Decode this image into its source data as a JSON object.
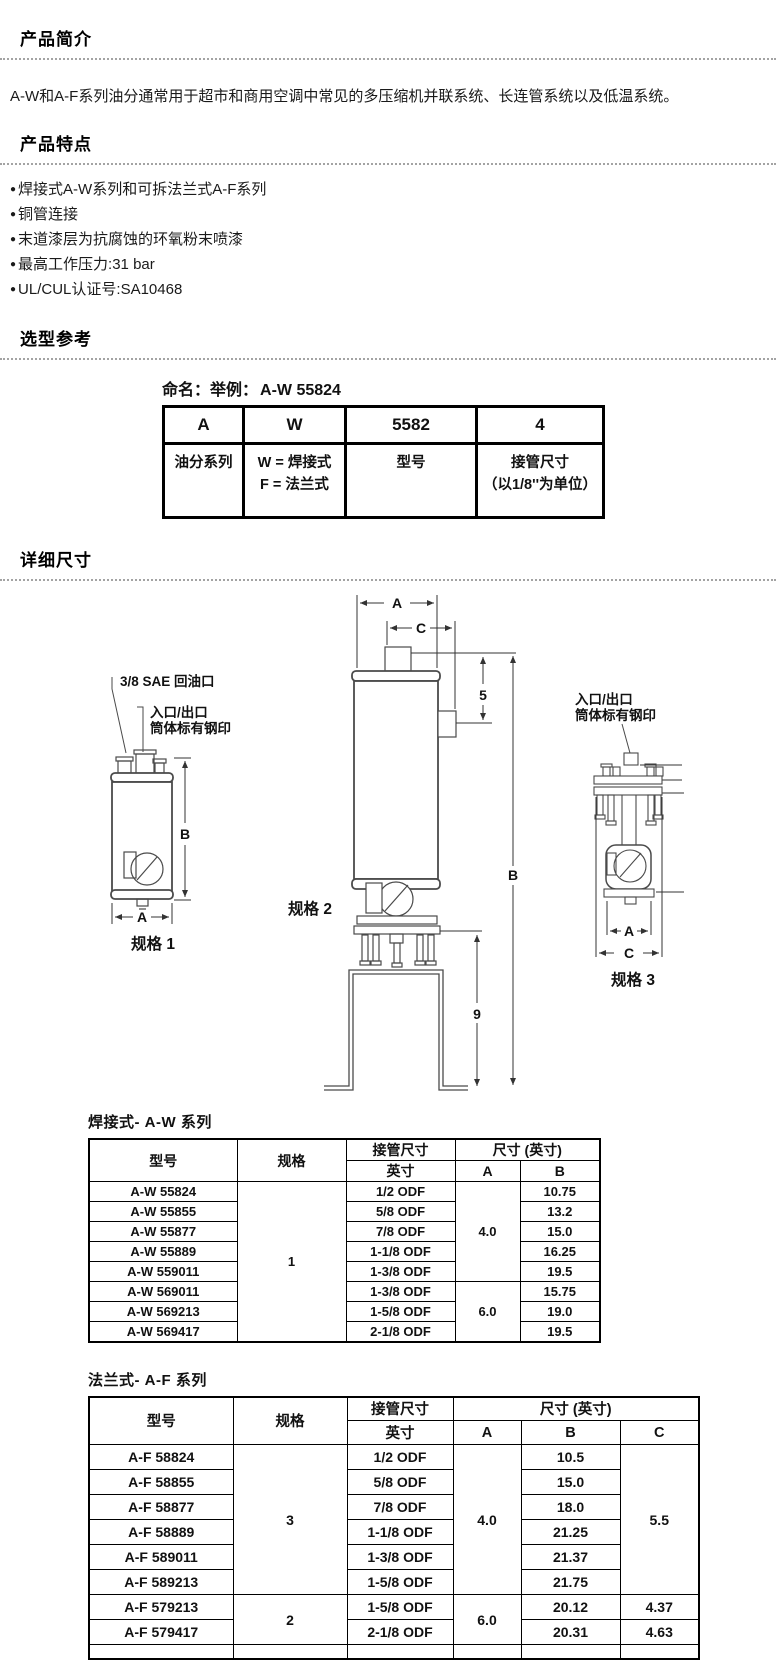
{
  "sections": {
    "intro": {
      "title": "产品简介",
      "body": "A-W和A-F系列油分通常用于超市和商用空调中常见的多压缩机并联系统、长连管系统以及低温系统。"
    },
    "features": {
      "title": "产品特点",
      "bullet": "●",
      "items": [
        "焊接式A-W系列和可拆法兰式A-F系列",
        "铜管连接",
        "末道漆层为抗腐蚀的环氧粉末喷漆",
        "最高工作压力:31 bar",
        "UL/CUL认证号:SA10468"
      ]
    },
    "selection": {
      "title": "选型参考"
    },
    "dimensions": {
      "title": "详细尺寸"
    }
  },
  "naming": {
    "caption_label": "命名：举例：",
    "caption_example": "A-W 55824",
    "columns": [
      {
        "code": "A",
        "desc_lines": [
          "油分系列",
          ""
        ]
      },
      {
        "code": "W",
        "desc_lines": [
          "W = 焊接式",
          "F = 法兰式"
        ]
      },
      {
        "code": "5582",
        "desc_lines": [
          "型号",
          ""
        ]
      },
      {
        "code": "4",
        "desc_lines": [
          "接管尺寸",
          "（以1/8''为单位）"
        ]
      }
    ]
  },
  "diagram": {
    "callouts": {
      "oil_return": "3/8 SAE 回油口",
      "inlet_outlet": "入口/出口",
      "stamped": "筒体标有钢印"
    },
    "dims": {
      "A": "A",
      "B": "B",
      "C": "C",
      "five": "5",
      "nine": "9"
    },
    "captions": {
      "spec1": "规格 1",
      "spec2": "规格 2",
      "spec3": "规格 3"
    }
  },
  "table_aw": {
    "caption": "焊接式- A-W 系列",
    "head": {
      "model": "型号",
      "spec": "规格",
      "conn": "接管尺寸",
      "dims_group": "尺寸 (英寸)",
      "inch": "英寸",
      "colA": "A",
      "colB": "B"
    },
    "spec_value": "1",
    "a_values": [
      "4.0",
      "6.0"
    ],
    "rows": [
      {
        "model": "A-W 55824",
        "conn": "1/2 ODF",
        "b": "10.75"
      },
      {
        "model": "A-W 55855",
        "conn": "5/8 ODF",
        "b": "13.2"
      },
      {
        "model": "A-W 55877",
        "conn": "7/8 ODF",
        "b": "15.0"
      },
      {
        "model": "A-W 55889",
        "conn": "1-1/8 ODF",
        "b": "16.25"
      },
      {
        "model": "A-W 559011",
        "conn": "1-3/8 ODF",
        "b": "19.5"
      },
      {
        "model": "A-W 569011",
        "conn": "1-3/8 ODF",
        "b": "15.75"
      },
      {
        "model": "A-W 569213",
        "conn": "1-5/8 ODF",
        "b": "19.0"
      },
      {
        "model": "A-W 569417",
        "conn": "2-1/8 ODF",
        "b": "19.5"
      }
    ]
  },
  "table_af": {
    "caption": "法兰式- A-F 系列",
    "head": {
      "model": "型号",
      "spec": "规格",
      "conn": "接管尺寸",
      "dims_group": "尺寸 (英寸)",
      "inch": "英寸",
      "colA": "A",
      "colB": "B",
      "colC": "C"
    },
    "spec_values": [
      "3",
      "2"
    ],
    "a_values": [
      "4.0",
      "6.0"
    ],
    "c_shared": "5.5",
    "rows": [
      {
        "model": "A-F 58824",
        "conn": "1/2 ODF",
        "b": "10.5"
      },
      {
        "model": "A-F 58855",
        "conn": "5/8 ODF",
        "b": "15.0"
      },
      {
        "model": "A-F 58877",
        "conn": "7/8 ODF",
        "b": "18.0"
      },
      {
        "model": "A-F 58889",
        "conn": "1-1/8 ODF",
        "b": "21.25"
      },
      {
        "model": "A-F 589011",
        "conn": "1-3/8 ODF",
        "b": "21.37"
      },
      {
        "model": "A-F 589213",
        "conn": "1-5/8 ODF",
        "b": "21.75"
      },
      {
        "model": "A-F 579213",
        "conn": "1-5/8 ODF",
        "b": "20.12",
        "c": "4.37"
      },
      {
        "model": "A-F 579417",
        "conn": "2-1/8 ODF",
        "b": "20.31",
        "c": "4.63"
      }
    ]
  }
}
